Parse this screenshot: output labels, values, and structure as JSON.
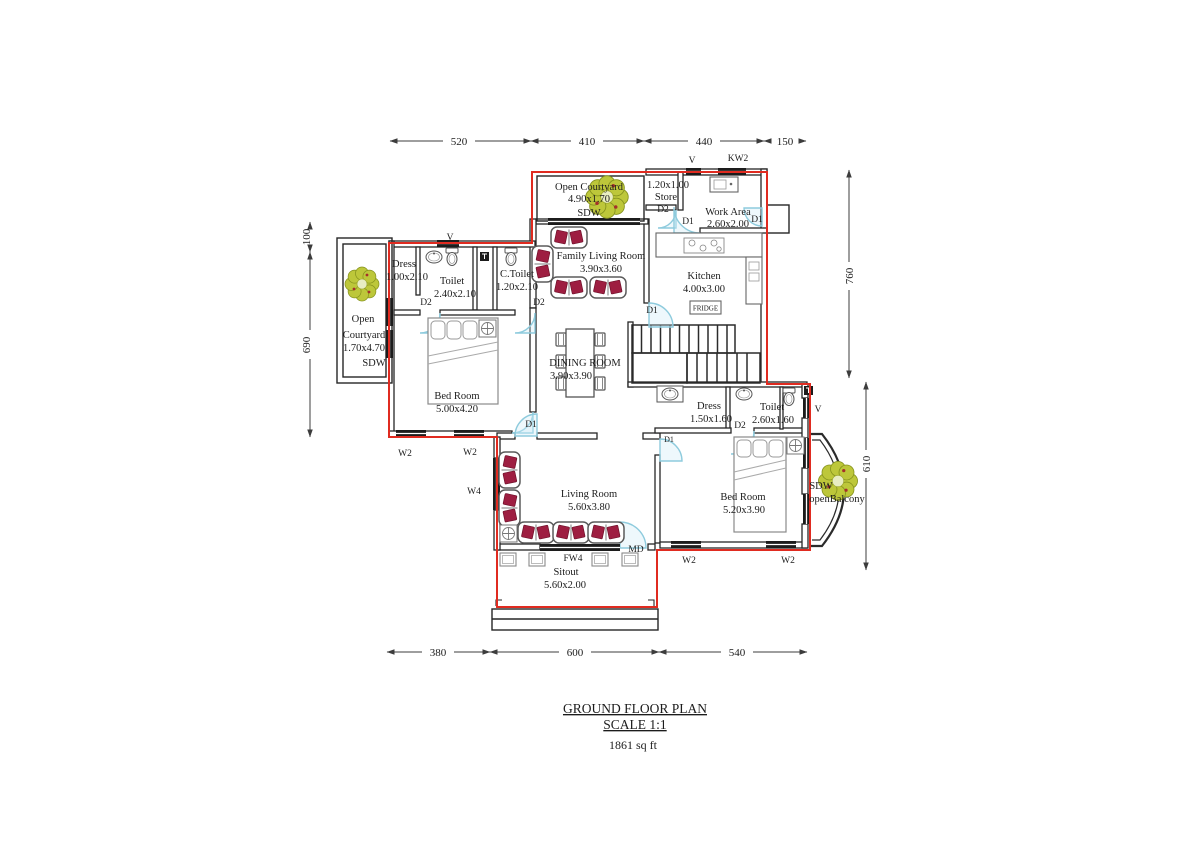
{
  "plan": {
    "title": "GROUND FLOOR PLAN",
    "scale": "SCALE 1:1",
    "area": "1861 sq ft"
  },
  "dims": {
    "top": [
      "520",
      "410",
      "440",
      "150"
    ],
    "bottom": [
      "380",
      "600",
      "540"
    ],
    "left": [
      "100",
      "690"
    ],
    "right": [
      "760",
      "610"
    ]
  },
  "rooms": {
    "courtyard_top": {
      "name": "Open Courtyard",
      "size": "4.90x1.70",
      "window": "SDW"
    },
    "store": {
      "size": "1.20x1.00",
      "name": "Store"
    },
    "work_area": {
      "name": "Work Area",
      "size": "2.60x2.00"
    },
    "kitchen": {
      "name": "Kitchen",
      "size": "4.00x3.00",
      "appliance": "FRIDGE"
    },
    "family_living": {
      "name": "Family Living Room",
      "size": "3.90x3.60"
    },
    "dress1": {
      "name": "Dress",
      "size": "1.00x2.10"
    },
    "toilet1": {
      "name": "Toilet",
      "size": "2.40x2.10"
    },
    "ctoilet": {
      "name": "C.Toilet",
      "size": "1.20x2.10"
    },
    "courtyard_left": {
      "name_line1": "Open",
      "name_line2": "Courtyard",
      "size": "1.70x4.70",
      "window": "SDW"
    },
    "bedroom1": {
      "name": "Bed Room",
      "size": "5.00x4.20"
    },
    "dining": {
      "name": "DINING ROOM",
      "size": "3.90x3.90"
    },
    "dress2": {
      "name": "Dress",
      "size": "1.50x1.60"
    },
    "toilet2": {
      "name": "Toilet",
      "size": "2.60x1.60"
    },
    "bedroom2": {
      "name": "Bed Room",
      "size": "5.20x3.90"
    },
    "living": {
      "name": "Living Room",
      "size": "5.60x3.80"
    },
    "sitout": {
      "name": "Sitout",
      "size": "5.60x2.00"
    },
    "balcony": {
      "window": "SDW",
      "name": "openBalcony"
    }
  },
  "markers": {
    "v": "V",
    "kw2": "KW2",
    "d1": "D1",
    "d2": "D2",
    "w2": "W2",
    "w4": "W4",
    "md": "MD",
    "fw4": "FW4"
  }
}
